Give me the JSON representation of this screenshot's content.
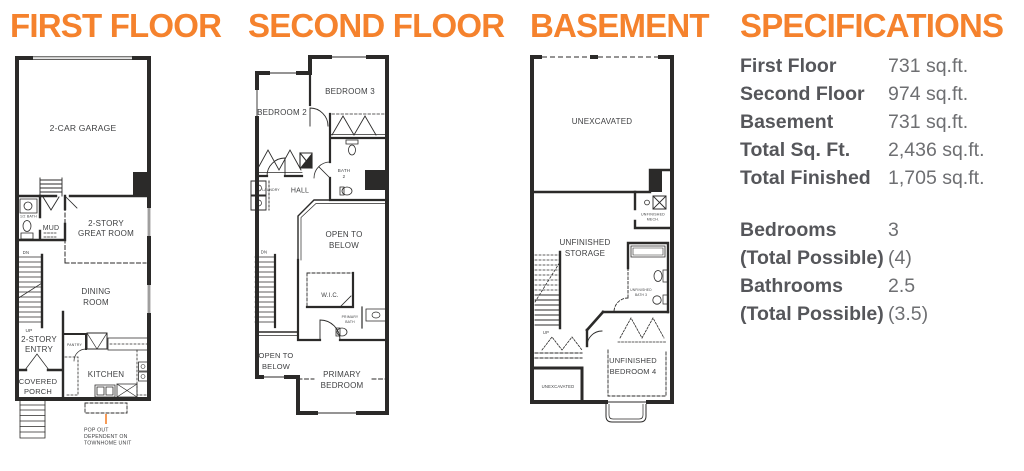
{
  "colors": {
    "accent": "#f5822d",
    "spec_label": "#55565a",
    "spec_value": "#6e6f72",
    "wall": "#2b2a29"
  },
  "titles": {
    "first_floor": "FIRST FLOOR",
    "second_floor": "SECOND FLOOR",
    "basement": "BASEMENT",
    "specifications": "SPECIFICATIONS"
  },
  "first_floor": {
    "labels": {
      "garage": "2-CAR GARAGE",
      "half_bath": "1/2 BATH",
      "mud": "MUD",
      "great_room": [
        "2-STORY",
        "GREAT ROOM"
      ],
      "dn": "DN",
      "dining": [
        "DINING",
        "ROOM"
      ],
      "up": "UP",
      "entry": [
        "2-STORY",
        "ENTRY"
      ],
      "pantry": "PANTRY",
      "kitchen": "KITCHEN",
      "porch": [
        "COVERED",
        "PORCH"
      ],
      "popout_note": [
        "POP OUT",
        "DEPENDENT ON",
        "TOWNHOME UNIT"
      ]
    }
  },
  "second_floor": {
    "labels": {
      "bedroom2": "BEDROOM 2",
      "bedroom3": "BEDROOM 3",
      "bath2": [
        "BATH",
        "2"
      ],
      "laundry": "LAUNDRY",
      "hall": "HALL",
      "open_below_a": [
        "OPEN TO",
        "BELOW"
      ],
      "dn": "DN",
      "wic": "W.I.C.",
      "primary_bath": [
        "PRIMARY",
        "BATH"
      ],
      "open_below_b": [
        "OPEN TO",
        "BELOW"
      ],
      "primary_bedroom": [
        "PRIMARY",
        "BEDROOM"
      ]
    }
  },
  "basement": {
    "labels": {
      "unexcavated": "UNEXCAVATED",
      "mech": [
        "UNFINISHED",
        "MECH."
      ],
      "storage": [
        "UNFINISHED",
        "STORAGE"
      ],
      "up": "UP",
      "bath3": [
        "UNFINISHED",
        "BATH 3"
      ],
      "bedroom4": [
        "UNFINISHED",
        "BEDROOM 4"
      ],
      "unexcavated_small": "UNEXCAVATED"
    }
  },
  "specifications": {
    "areas": [
      {
        "label": "First Floor",
        "value": "731 sq.ft."
      },
      {
        "label": "Second Floor",
        "value": "974 sq.ft."
      },
      {
        "label": "Basement",
        "value": "731 sq.ft."
      },
      {
        "label": "Total Sq. Ft.",
        "value": "2,436 sq.ft."
      },
      {
        "label": "Total Finished",
        "value": "1,705 sq.ft."
      }
    ],
    "counts": [
      {
        "label": "Bedrooms",
        "value": "3"
      },
      {
        "label": "(Total Possible)",
        "value": "(4)"
      },
      {
        "label": "Bathrooms",
        "value": "2.5"
      },
      {
        "label": "(Total Possible)",
        "value": "(3.5)"
      }
    ]
  }
}
